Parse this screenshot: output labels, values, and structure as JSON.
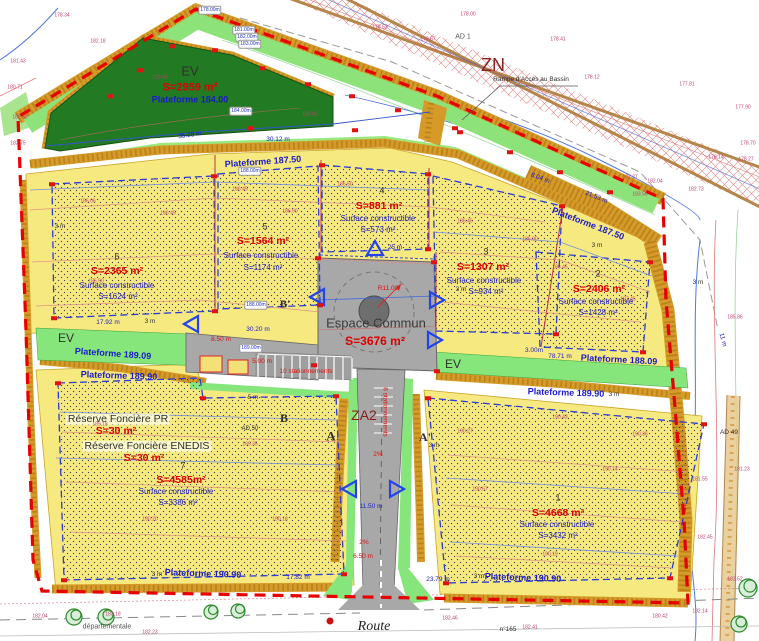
{
  "title_labels": {
    "zn": "ZN",
    "za2": "ZA2",
    "ad1": "AD 1",
    "ad49": "AD 49",
    "ad50": "AD 50",
    "n165": "n°165",
    "route": "Route",
    "departementale": "départementale",
    "rampe": "Rampe d'Accès au Bassin"
  },
  "ev_basin": {
    "label": "EV",
    "area": "S=2959 m²",
    "plateforme": "Plateforme 184.00"
  },
  "ev_strips": {
    "left": "EV",
    "right": "EV"
  },
  "espace_commun": {
    "label": "Espace Commun",
    "area": "S=3676 m²"
  },
  "plateformes": {
    "p18750_a": "Plateforme 187.50",
    "p18750_b": "Plateforme 187.50",
    "p18909": "Plateforme 189.09",
    "p18809": "Plateforme 188.09",
    "p18990_l": "Plateforme 189.90",
    "p18990_r": "Plateforme 189.90",
    "p19090_l": "Plateforme 190.90",
    "p19090_r": "Plateforme 190.90"
  },
  "reserves": [
    {
      "label": "Réserve Foncière PR",
      "area": "S=30 m²"
    },
    {
      "label": "Réserve Foncière ENEDIS",
      "area": "S=30 m²"
    }
  ],
  "lots": [
    {
      "num": "1",
      "area": "S=4668 m²",
      "sc_label": "Surface constructible",
      "sc_area": "S=3432 m²"
    },
    {
      "num": "2",
      "area": "S=2406 m²",
      "sc_label": "Surface constructible",
      "sc_area": "S=1428 m²"
    },
    {
      "num": "3",
      "area": "S=1307 m²",
      "sc_label": "Surface constructible",
      "sc_area": "S=934 m²"
    },
    {
      "num": "4",
      "area": "S=881 m²",
      "sc_label": "Surface constructible",
      "sc_area": "S=573 m²"
    },
    {
      "num": "5",
      "area": "S=1564 m²",
      "sc_label": "Surface constructible",
      "sc_area": "S=1174 m²"
    },
    {
      "num": "6",
      "area": "S=2365 m²",
      "sc_label": "Surface constructible",
      "sc_area": "S=1624 m²"
    },
    {
      "num": "7",
      "area": "S=4585m²",
      "sc_label": "Surface constructible",
      "sc_area": "S=3386 m²"
    }
  ],
  "sections": {
    "a": "A",
    "a_prime": "A'",
    "b": "B",
    "b_prime": "B'"
  },
  "colors": {
    "boundary": "#e60000",
    "plateau": "#f6e97f",
    "embankment": "#d69a28",
    "ev_green": "#86e67c",
    "basin_green": "#227a22",
    "road_gray": "#a8a8a8",
    "text_red": "#e00000",
    "text_blue": "#1a1acc",
    "zone_red": "#8b2020"
  },
  "dimensions": [
    {
      "t": "25 m",
      "x": 395,
      "y": 248,
      "c": "b"
    },
    {
      "t": "R11.00",
      "x": 388,
      "y": 289,
      "c": "r"
    },
    {
      "t": "3.00m",
      "x": 534,
      "y": 351,
      "c": "b"
    },
    {
      "t": "78.71 m",
      "x": 560,
      "y": 357,
      "c": "b"
    },
    {
      "t": "11.50 m",
      "x": 371,
      "y": 507,
      "c": "b"
    },
    {
      "t": "6.50 m",
      "x": 363,
      "y": 557,
      "c": "r"
    },
    {
      "t": "2%",
      "x": 378,
      "y": 455,
      "c": "r"
    },
    {
      "t": "2%",
      "x": 364,
      "y": 543,
      "c": "r"
    },
    {
      "t": "3 m",
      "x": 60,
      "y": 227,
      "c": "d"
    },
    {
      "t": "3 m",
      "x": 150,
      "y": 322,
      "c": "d"
    },
    {
      "t": "3 m",
      "x": 597,
      "y": 246,
      "c": "d"
    },
    {
      "t": "3 m",
      "x": 698,
      "y": 283,
      "c": "d"
    },
    {
      "t": "3 m",
      "x": 461,
      "y": 290,
      "c": "d"
    },
    {
      "t": "3 m",
      "x": 434,
      "y": 446,
      "c": "d"
    },
    {
      "t": "3 m",
      "x": 614,
      "y": 395,
      "c": "d"
    },
    {
      "t": "3 m",
      "x": 479,
      "y": 577,
      "c": "d"
    },
    {
      "t": "3 m",
      "x": 157,
      "y": 575,
      "c": "d"
    },
    {
      "t": "5 m",
      "x": 253,
      "y": 398,
      "c": "d"
    },
    {
      "t": "11 m",
      "x": 722,
      "y": 340,
      "c": "b",
      "rot": 75
    },
    {
      "t": "17.92 m",
      "x": 108,
      "y": 323,
      "c": "b"
    },
    {
      "t": "30.20 m",
      "x": 258,
      "y": 330,
      "c": "b"
    },
    {
      "t": "30.12 m",
      "x": 278,
      "y": 140,
      "c": "b"
    },
    {
      "t": "35.28 m",
      "x": 190,
      "y": 136,
      "c": "b",
      "rot": -8
    },
    {
      "t": "8.50 m",
      "x": 221,
      "y": 340,
      "c": "r"
    },
    {
      "t": "5.00 m",
      "x": 262,
      "y": 362,
      "c": "r"
    },
    {
      "t": "23.79 m",
      "x": 438,
      "y": 580,
      "c": "b"
    },
    {
      "t": "17.82 m",
      "x": 298,
      "y": 578,
      "c": "b"
    },
    {
      "t": "8.04 m",
      "x": 540,
      "y": 179,
      "c": "b",
      "rot": 20
    },
    {
      "t": "21.53 m",
      "x": 596,
      "y": 198,
      "c": "b",
      "rot": 22
    },
    {
      "t": "10 stationnements",
      "x": 306,
      "y": 372,
      "c": "r"
    },
    {
      "t": "6 stationnements",
      "x": 384,
      "y": 412,
      "c": "r",
      "rot": 90
    }
  ],
  "elev_boxes": [
    {
      "t": "178.00m",
      "x": 210,
      "y": 10
    },
    {
      "t": "181.00m",
      "x": 244,
      "y": 30
    },
    {
      "t": "182.00m",
      "x": 247,
      "y": 37
    },
    {
      "t": "183.00m",
      "x": 250,
      "y": 44
    },
    {
      "t": "184.00m",
      "x": 241,
      "y": 111
    },
    {
      "t": "188.00m",
      "x": 250,
      "y": 171
    },
    {
      "t": "188.00m",
      "x": 256,
      "y": 305
    },
    {
      "t": "189.00m",
      "x": 251,
      "y": 348
    }
  ],
  "scatter": [
    {
      "t": "178.34",
      "x": 62,
      "y": 16
    },
    {
      "t": "182.18",
      "x": 98,
      "y": 42
    },
    {
      "t": "181.43",
      "x": 18,
      "y": 62
    },
    {
      "t": "180.71",
      "x": 15,
      "y": 88
    },
    {
      "t": "182.32",
      "x": 20,
      "y": 118
    },
    {
      "t": "182.75",
      "x": 18,
      "y": 144
    },
    {
      "t": "183.43",
      "x": 160,
      "y": 78
    },
    {
      "t": "183.60",
      "x": 310,
      "y": 115
    },
    {
      "t": "178.52",
      "x": 380,
      "y": 28
    },
    {
      "t": "178.67",
      "x": 428,
      "y": 40
    },
    {
      "t": "178.00",
      "x": 468,
      "y": 15
    },
    {
      "t": "178.41",
      "x": 558,
      "y": 40
    },
    {
      "t": "178.12",
      "x": 592,
      "y": 78
    },
    {
      "t": "177.81",
      "x": 687,
      "y": 85
    },
    {
      "t": "177.90",
      "x": 743,
      "y": 108
    },
    {
      "t": "178.70",
      "x": 748,
      "y": 144
    },
    {
      "t": "178.14",
      "x": 716,
      "y": 158
    },
    {
      "t": "178.27",
      "x": 746,
      "y": 160
    },
    {
      "t": "182.27",
      "x": 630,
      "y": 178
    },
    {
      "t": "182.04",
      "x": 655,
      "y": 182
    },
    {
      "t": "182.73",
      "x": 696,
      "y": 190
    },
    {
      "t": "183.56",
      "x": 640,
      "y": 195
    },
    {
      "t": "185.86",
      "x": 735,
      "y": 318
    },
    {
      "t": "181.55",
      "x": 700,
      "y": 480
    },
    {
      "t": "181.23",
      "x": 742,
      "y": 470
    },
    {
      "t": "182.45",
      "x": 705,
      "y": 538
    },
    {
      "t": "182.52",
      "x": 735,
      "y": 580
    },
    {
      "t": "182.14",
      "x": 700,
      "y": 612
    },
    {
      "t": "180.42",
      "x": 660,
      "y": 617
    },
    {
      "t": "182.04",
      "x": 40,
      "y": 617
    },
    {
      "t": "183.18",
      "x": 113,
      "y": 615
    },
    {
      "t": "182.46",
      "x": 450,
      "y": 619
    },
    {
      "t": "182.41",
      "x": 530,
      "y": 628
    },
    {
      "t": "182.23",
      "x": 150,
      "y": 633
    },
    {
      "t": "186.06",
      "x": 88,
      "y": 202
    },
    {
      "t": "186.45",
      "x": 168,
      "y": 214
    },
    {
      "t": "186.90",
      "x": 96,
      "y": 282
    },
    {
      "t": "186.45",
      "x": 240,
      "y": 190
    },
    {
      "t": "186.90",
      "x": 290,
      "y": 212
    },
    {
      "t": "186.50",
      "x": 345,
      "y": 185
    },
    {
      "t": "186.45",
      "x": 465,
      "y": 222
    },
    {
      "t": "186.90",
      "x": 530,
      "y": 240
    },
    {
      "t": "186.45",
      "x": 560,
      "y": 268
    },
    {
      "t": "187.45",
      "x": 628,
      "y": 300
    },
    {
      "t": "189.18",
      "x": 100,
      "y": 425
    },
    {
      "t": "189.35",
      "x": 250,
      "y": 445
    },
    {
      "t": "190.20",
      "x": 150,
      "y": 520
    },
    {
      "t": "190.18",
      "x": 280,
      "y": 520
    },
    {
      "t": "190.27",
      "x": 465,
      "y": 432
    },
    {
      "t": "190.43",
      "x": 560,
      "y": 418
    },
    {
      "t": "190.36",
      "x": 640,
      "y": 435
    },
    {
      "t": "190.67",
      "x": 480,
      "y": 490
    },
    {
      "t": "190.14",
      "x": 610,
      "y": 470
    },
    {
      "t": "190.19",
      "x": 550,
      "y": 555
    }
  ],
  "markers": [
    [
      52,
      184
    ],
    [
      214,
      176
    ],
    [
      322,
      165
    ],
    [
      428,
      174
    ],
    [
      562,
      206
    ],
    [
      650,
      262
    ],
    [
      54,
      318
    ],
    [
      215,
      311
    ],
    [
      320,
      305
    ],
    [
      428,
      249
    ],
    [
      556,
      334
    ],
    [
      643,
      352
    ],
    [
      58,
      383
    ],
    [
      203,
      398
    ],
    [
      336,
      396
    ],
    [
      344,
      574
    ],
    [
      64,
      580
    ],
    [
      428,
      398
    ],
    [
      704,
      424
    ],
    [
      670,
      578
    ],
    [
      446,
      583
    ],
    [
      318,
      258
    ],
    [
      434,
      262
    ],
    [
      437,
      371
    ],
    [
      314,
      365
    ],
    [
      110,
      96
    ],
    [
      140,
      70
    ],
    [
      172,
      46
    ],
    [
      215,
      50
    ],
    [
      262,
      68
    ],
    [
      308,
      84
    ],
    [
      352,
      96
    ],
    [
      398,
      110
    ],
    [
      455,
      128
    ],
    [
      510,
      152
    ],
    [
      560,
      172
    ],
    [
      610,
      192
    ],
    [
      250,
      128
    ],
    [
      355,
      130
    ],
    [
      460,
      132
    ]
  ]
}
